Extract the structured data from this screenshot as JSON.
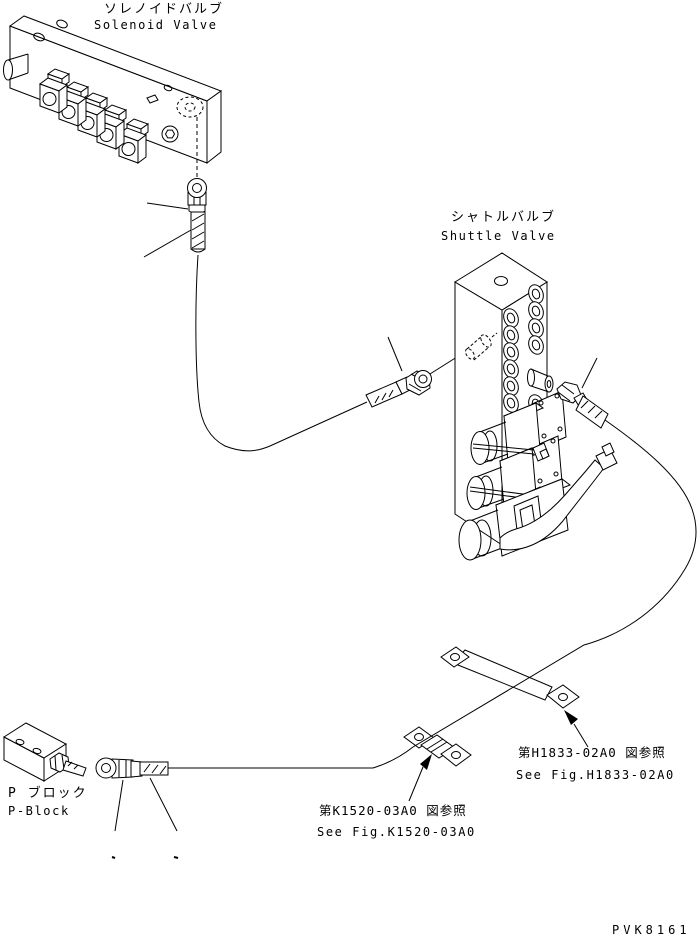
{
  "page": {
    "background_color": "#ffffff",
    "line_color": "#000000",
    "drawing_number": "PVK8161"
  },
  "labels": {
    "solenoid_valve_jp": "ソレノイドバルブ",
    "solenoid_valve_en": "Solenoid Valve",
    "shuttle_valve_jp": "シャトルバルブ",
    "shuttle_valve_en": "Shuttle Valve",
    "p_block_jp": "P ブロック",
    "p_block_en": "P-Block",
    "ref_k1520_jp": "第K1520-03A0 図参照",
    "ref_k1520_en": "See Fig.K1520-03A0",
    "ref_h1833_jp": "第H1833-02A0 図参照",
    "ref_h1833_en": "See Fig.H1833-02A0"
  }
}
